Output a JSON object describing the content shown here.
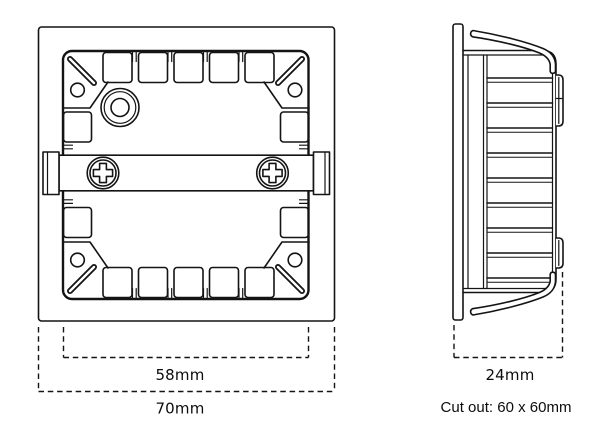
{
  "colors": {
    "background": "#ffffff",
    "line": "#141414"
  },
  "labels": {
    "front_inner_width": "58mm",
    "front_outer_width": "70mm",
    "side_depth": "24mm",
    "cutout_note": "Cut out: 60 x 60mm"
  }
}
